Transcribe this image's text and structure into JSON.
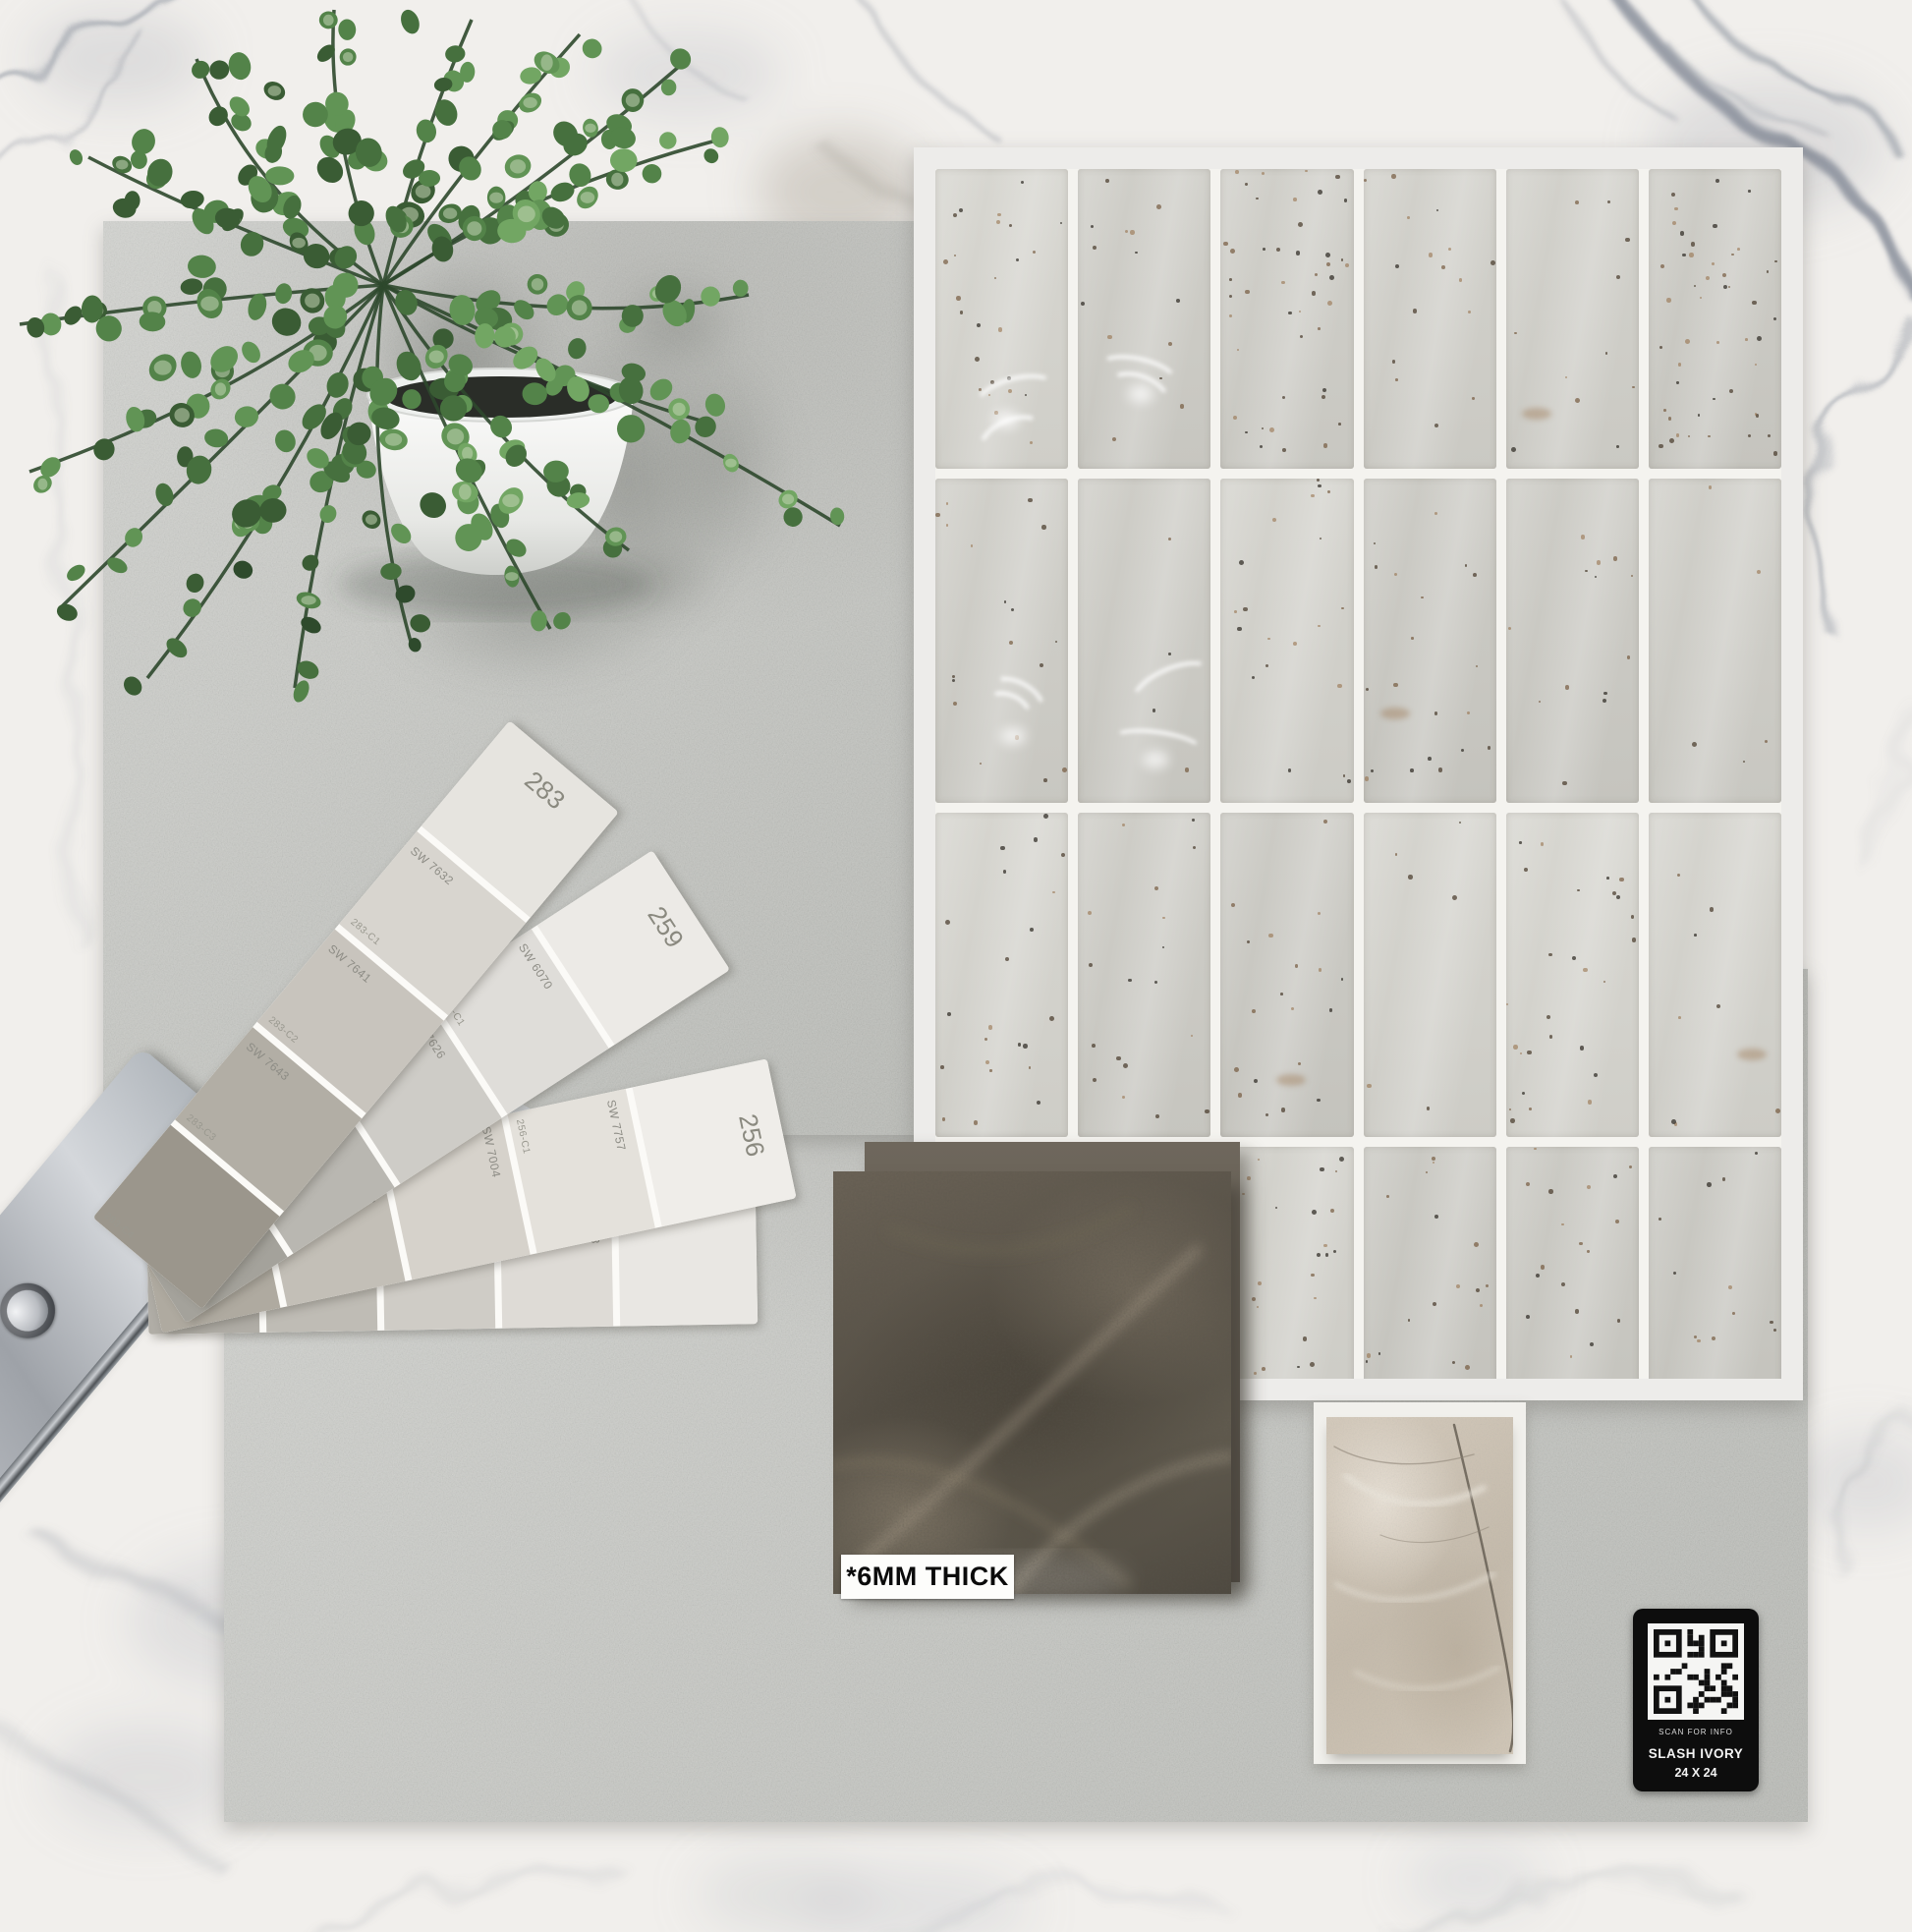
{
  "palette": {
    "marble_base": "#f1efec",
    "marble_vein": "#828a96",
    "concrete_tile": "#c7c8c4",
    "board_frame": "#edecea",
    "subway_tile": "#ceccc6",
    "grout": "#f4f3ef",
    "dark_tile": "#5b5346",
    "beige_tile": "#c9bfb1",
    "qr_background": "#0d0d0d",
    "leaf_green": "#4c7a44",
    "pot_white": "#f3f3f1",
    "clasp_silver": "#b4b8bd"
  },
  "fan_deck": {
    "clasp_letter": "S",
    "strips": [
      {
        "number": "283",
        "tip_color": "#e6e4df",
        "swatches": [
          {
            "sw": "SW 7632",
            "code": "283-C1",
            "color": "#d8d5cf"
          },
          {
            "sw": "SW 7641",
            "code": "283-C2",
            "color": "#c8c4bd"
          },
          {
            "sw": "SW 7643",
            "code": "283-C3",
            "color": "#b2aea5"
          },
          {
            "sw": "",
            "code": "283-C4",
            "color": "#9b968c"
          }
        ]
      },
      {
        "number": "259",
        "tip_color": "#eceae6",
        "swatches": [
          {
            "sw": "SW 6070",
            "code": "259-C1",
            "color": "#dfddd9"
          },
          {
            "sw": "SW 7626",
            "code": "259-C2",
            "color": "#ceccc7"
          },
          {
            "sw": "SW 7035",
            "code": "259-C3",
            "color": "#b9b7b1"
          },
          {
            "sw": "",
            "code": "259-C4",
            "color": "#a4a29b"
          }
        ]
      },
      {
        "number": "256",
        "tip_color": "#efede9",
        "swatches": [
          {
            "sw": "SW 7757",
            "code": "256-C1",
            "color": "#e4e1db"
          },
          {
            "sw": "SW 7004",
            "code": "256-C2",
            "color": "#d6d2cb"
          },
          {
            "sw": "SW 7028",
            "code": "256-C3",
            "color": "#c3bfb7"
          },
          {
            "sw": "SW 7014",
            "code": "256-C4",
            "color": "#afaaa0"
          }
        ]
      },
      {
        "number": "",
        "tip_color": "#e9e7e3",
        "swatches": [
          {
            "sw": "SW 7003",
            "code": "",
            "color": "#dedbd6"
          },
          {
            "sw": "SW 7646",
            "code": "",
            "color": "#cfccc6"
          },
          {
            "sw": "",
            "code": "",
            "color": "#bfbcb5"
          },
          {
            "sw": "",
            "code": "",
            "color": "#b0ada6"
          }
        ]
      }
    ]
  },
  "dark_tile": {
    "label": "*6MM THICK"
  },
  "qr_label": {
    "caption": "SCAN FOR INFO",
    "product": "SLASH IVORY",
    "size": "24 X 24"
  }
}
